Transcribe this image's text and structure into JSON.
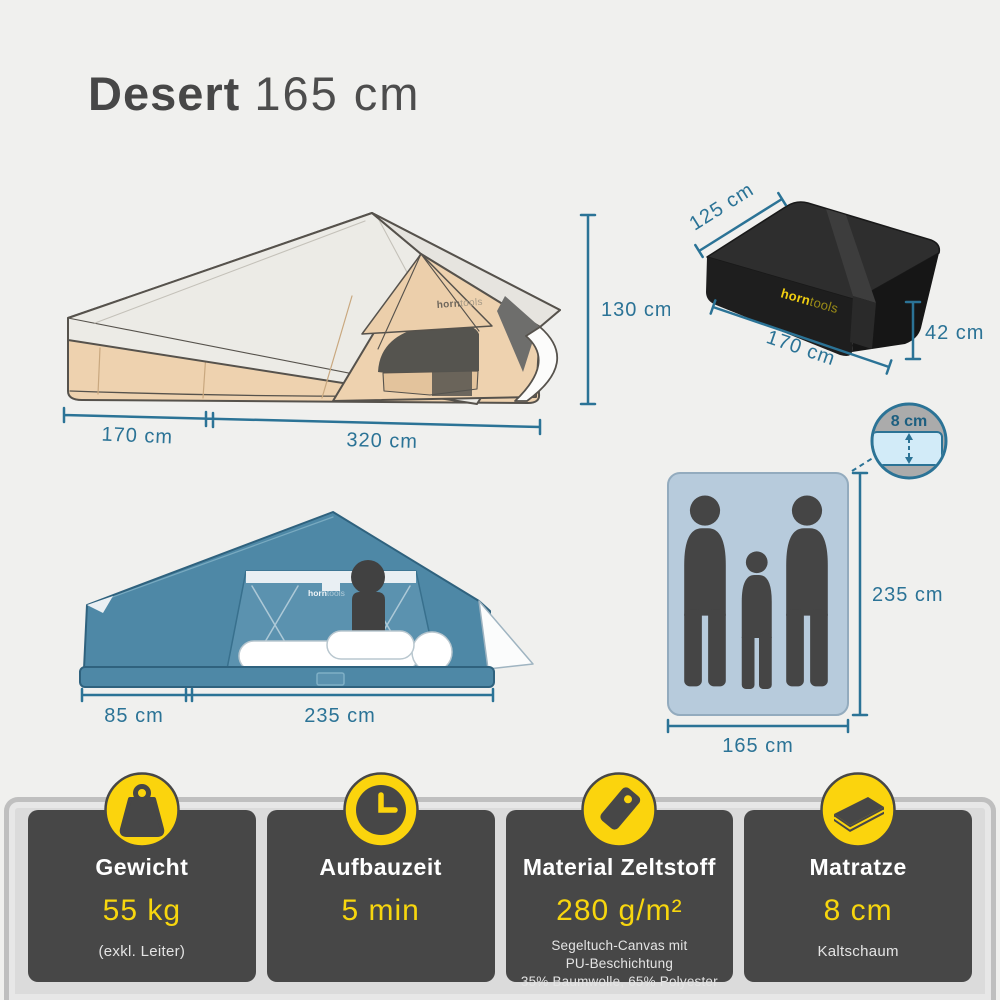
{
  "page": {
    "background": "#f0f0ee"
  },
  "title": {
    "product": "Desert",
    "variant": "165 cm"
  },
  "brand": {
    "logo_bold": "horn",
    "logo_light": "tools"
  },
  "colors": {
    "dimension_teal": "#2b7396",
    "accent_yellow": "#fbd40d",
    "tent_canvas_tan": "#eed2af",
    "tent_roof_white": "#ecebe6",
    "tent_blue": "#4e88a6",
    "mattress_blue": "#b7cbdc",
    "card_dark": "#474747"
  },
  "diagrams": {
    "tent_side": {
      "label_width_left": "170 cm",
      "label_width_main": "320 cm",
      "label_height": "130 cm"
    },
    "packed_tent": {
      "label_depth": "125 cm",
      "label_width": "170 cm",
      "label_height": "42 cm"
    },
    "tent_front": {
      "label_annex": "85 cm",
      "label_sleeping": "235 cm"
    },
    "mattress_top": {
      "label_length": "235 cm",
      "label_width": "165 cm",
      "callout_thickness": "8 cm"
    }
  },
  "spec_cards": [
    {
      "icon": "weight-icon",
      "title": "Gewicht",
      "value": "55 kg",
      "note": "(exkl. Leiter)"
    },
    {
      "icon": "clock-icon",
      "title": "Aufbauzeit",
      "value": "5 min",
      "note": ""
    },
    {
      "icon": "tag-icon",
      "title": "Material Zeltstoff",
      "value": "280 g/m²",
      "note_lines": [
        "Segeltuch-Canvas mit",
        "PU-Beschichtung",
        "35% Baumwolle, 65% Polyester"
      ]
    },
    {
      "icon": "mattress-icon",
      "title": "Matratze",
      "value": "8 cm",
      "note": "Kaltschaum"
    }
  ]
}
